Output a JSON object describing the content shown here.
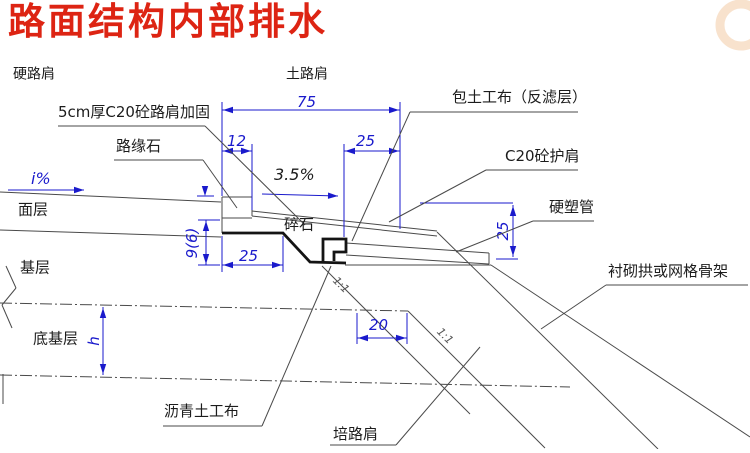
{
  "title": {
    "text": "路面结构内部排水",
    "color": "#dd2413"
  },
  "watermark": {
    "color": "#f3cba4"
  },
  "drawing": {
    "colors": {
      "line": "#4a4a4a",
      "thick": "#141414",
      "dim": "#1a1acc",
      "text": "#1c1c1c",
      "slope": "#555555"
    },
    "grey_lines": [
      [
        0,
        192,
        221,
        202
      ],
      [
        0,
        230,
        221,
        237
      ],
      [
        222,
        197,
        252,
        197
      ],
      [
        222,
        197,
        222,
        233
      ],
      [
        252,
        197,
        252,
        216
      ],
      [
        222,
        218,
        252,
        218
      ],
      [
        252,
        211,
        437,
        231
      ],
      [
        252,
        216,
        437,
        236
      ],
      [
        346,
        243,
        489,
        253
      ],
      [
        346,
        255,
        489,
        264
      ],
      [
        489,
        253,
        489,
        264
      ],
      [
        345,
        265,
        491,
        265
      ],
      [
        322,
        266,
        470,
        414
      ],
      [
        408,
        311,
        545,
        448
      ],
      [
        437,
        232,
        658,
        449
      ],
      [
        491,
        265,
        750,
        437
      ],
      [
        6,
        266,
        16,
        288
      ],
      [
        16,
        288,
        2,
        305
      ],
      [
        2,
        305,
        12,
        328
      ],
      [
        3,
        374,
        3,
        404
      ]
    ],
    "dash_lines": [
      [
        0,
        303,
        408,
        311
      ],
      [
        0,
        375,
        570,
        387
      ]
    ],
    "blue_lines": [
      [
        222,
        102,
        222,
        196
      ],
      [
        400,
        102,
        400,
        229
      ],
      [
        252,
        144,
        252,
        210
      ],
      [
        344,
        144,
        344,
        237
      ],
      [
        420,
        203,
        513,
        203
      ],
      [
        496,
        259,
        518,
        259
      ],
      [
        357,
        313,
        357,
        344
      ],
      [
        407,
        313,
        407,
        344
      ],
      [
        222,
        236,
        222,
        272
      ],
      [
        283,
        236,
        283,
        272
      ],
      [
        198,
        220,
        220,
        220
      ],
      [
        198,
        265,
        220,
        265
      ],
      [
        197,
        196,
        214,
        196
      ],
      [
        205,
        186,
        205,
        193
      ]
    ],
    "blue_arrows": [
      [
        205,
        196,
        90
      ]
    ],
    "thick_paths": [
      "M222,233 L283,233 L310,262 L346,263",
      "M323,262 L323,239 L346,239 L346,252 L334,252 L334,261"
    ],
    "dims": [
      {
        "label": "75",
        "type": "h",
        "x1": 222,
        "x2": 400,
        "y": 110,
        "tx": 297,
        "ty": 94
      },
      {
        "label": "12",
        "type": "h",
        "x1": 222,
        "x2": 252,
        "y": 151,
        "tx": 227,
        "ty": 133
      },
      {
        "label": "25",
        "type": "h",
        "x1": 344,
        "x2": 400,
        "y": 151,
        "tx": 356,
        "ty": 133
      },
      {
        "label": "25",
        "type": "h",
        "x1": 222,
        "x2": 283,
        "y": 265,
        "tx": 239,
        "ty": 248
      },
      {
        "label": "20",
        "type": "h",
        "x1": 357,
        "x2": 407,
        "y": 338,
        "tx": 369,
        "ty": 317
      },
      {
        "label": "9(6)",
        "type": "v",
        "x": 206,
        "y1": 220,
        "y2": 265,
        "tx": 192,
        "ty": 243,
        "rot": -90
      },
      {
        "label": "25",
        "type": "v",
        "x": 513,
        "y1": 205,
        "y2": 257,
        "tx": 503,
        "ty": 231,
        "rot": -90
      },
      {
        "label": "h",
        "type": "v",
        "x": 103,
        "y1": 307,
        "y2": 375,
        "tx": 94,
        "ty": 341,
        "rot": -90
      }
    ],
    "slope_notes": [
      {
        "name": "cross-slope-i",
        "text": "i%",
        "tx": 31,
        "ty": 170,
        "color": "dim",
        "arrow": [
          8,
          190,
          84,
          190
        ]
      },
      {
        "name": "shoulder-slope-35",
        "text": "3.5%",
        "tx": 274,
        "ty": 166,
        "color": "text",
        "arrow": [
          262,
          194,
          338,
          196
        ]
      }
    ],
    "callouts": [
      {
        "name": "label-5cm-c20-shoulder-reinforcement",
        "text": "5cm厚C20砼路肩加固",
        "tx": 58,
        "ty": 104,
        "underline": [
          58,
          126,
          205,
          126
        ],
        "leader": [
          205,
          126,
          305,
          225
        ]
      },
      {
        "name": "label-curb",
        "text": "路缘石",
        "tx": 116,
        "ty": 138,
        "underline": [
          114,
          160,
          203,
          160
        ],
        "leader": [
          203,
          160,
          237,
          208
        ]
      },
      {
        "name": "label-geotextile-wrap",
        "text": "包土工布（反滤层）",
        "tx": 452,
        "ty": 89,
        "underline": [
          410,
          112,
          578,
          112
        ],
        "leader": [
          410,
          112,
          352,
          241
        ]
      },
      {
        "name": "label-c20-concrete-shoulder",
        "text": "C20砼护肩",
        "tx": 505,
        "ty": 148,
        "underline": [
          486,
          170,
          578,
          170
        ],
        "leader": [
          486,
          170,
          389,
          222
        ]
      },
      {
        "name": "label-rigid-plastic-pipe",
        "text": "硬塑管",
        "tx": 549,
        "ty": 199,
        "underline": [
          533,
          221,
          594,
          221
        ],
        "leader": [
          533,
          221,
          456,
          252
        ]
      },
      {
        "name": "label-lining-arch-or-grid-skeleton",
        "text": "衬砌拱或网格骨架",
        "tx": 608,
        "ty": 263,
        "underline": [
          606,
          285,
          748,
          285
        ],
        "leader": [
          606,
          285,
          541,
          329
        ]
      },
      {
        "name": "label-asphalt-geotextile",
        "text": "沥青土工布",
        "tx": 164,
        "ty": 403,
        "underline": [
          163,
          426,
          262,
          426
        ],
        "leader": [
          262,
          426,
          331,
          266
        ]
      },
      {
        "name": "label-fill-shoulder",
        "text": "培路肩",
        "tx": 333,
        "ty": 426,
        "underline": [
          330,
          445,
          396,
          445
        ],
        "leader": [
          396,
          445,
          480,
          347
        ]
      }
    ],
    "texts": [
      {
        "name": "label-hard-shoulder",
        "t": "硬路肩",
        "x": 13,
        "y": 66,
        "s": 14
      },
      {
        "name": "label-soil-shoulder",
        "t": "土路肩",
        "x": 286,
        "y": 66,
        "s": 14
      },
      {
        "name": "label-gravel",
        "t": "碎石",
        "x": 284,
        "y": 216,
        "s": 15
      },
      {
        "name": "label-surface-course",
        "t": "面层",
        "x": 18,
        "y": 201,
        "s": 15
      },
      {
        "name": "label-base-course",
        "t": "基层",
        "x": 20,
        "y": 259,
        "s": 15
      },
      {
        "name": "label-subbase-course",
        "t": "底基层",
        "x": 33,
        "y": 330,
        "s": 15
      },
      {
        "name": "slope-ratio-1-1-a",
        "t": "1:1",
        "x": 341,
        "y": 285,
        "s": 11,
        "rot": 45,
        "c": "slope",
        "i": true
      },
      {
        "name": "slope-ratio-1-1-b",
        "t": "1:1",
        "x": 445,
        "y": 336,
        "s": 11,
        "rot": 45,
        "c": "slope",
        "i": true
      }
    ]
  }
}
